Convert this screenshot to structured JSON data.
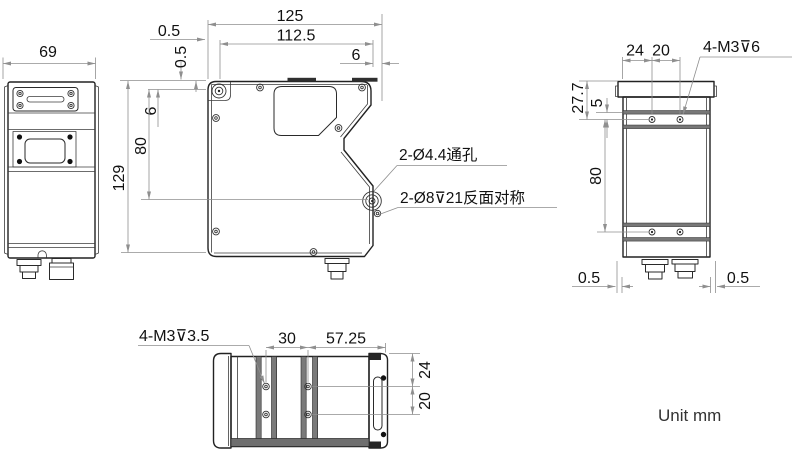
{
  "unit_label": "Unit mm",
  "front_view": {
    "dim_overall_width": "125",
    "dim_inner_width": "112.5",
    "dim_right_offset": "6",
    "dim_top_offset_h": "0.5",
    "dim_top_offset_v": "0.5",
    "dim_hole_top_offset": "6",
    "dim_hole_span": "80",
    "dim_overall_height": "129",
    "note_through_holes": "2-Ø4.4通孔",
    "note_counterbore_holes": "2-Ø8⊽21反面对称"
  },
  "left_view": {
    "dim_width": "69"
  },
  "right_view": {
    "dim_hole_col_1": "24",
    "dim_hole_col_2": "20",
    "note_tapped_holes": "4-M3⊽6",
    "dim_top_to_hole": "27.7",
    "dim_rail_offset": "5",
    "dim_hole_span": "80",
    "dim_bottom_offset_left": "0.5",
    "dim_bottom_offset_right": "0.5"
  },
  "bottom_view": {
    "note_tapped_holes": "4-M3⊽3.5",
    "dim_hole_col_span": "30",
    "dim_right_span": "57.25",
    "dim_edge_to_hole": "24",
    "dim_hole_row_span": "20"
  },
  "colors": {
    "outline": "#222222",
    "dimension_line": "#8f8f8f",
    "text": "#111111",
    "rail_fill": "#787878",
    "dark_strip": "#2f2f2f",
    "background": "#ffffff"
  }
}
